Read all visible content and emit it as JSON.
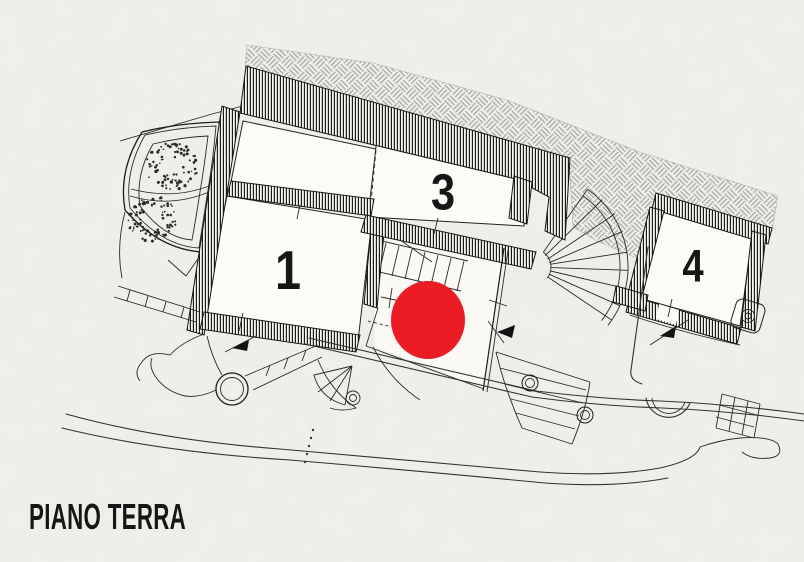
{
  "title": "PIANO TERRA",
  "rooms": [
    {
      "id": "room-1",
      "label": "1"
    },
    {
      "id": "room-3",
      "label": "3"
    },
    {
      "id": "room-4",
      "label": "4"
    }
  ],
  "marker": {
    "name": "highlighted-location",
    "color": "#ec1c24"
  },
  "colors": {
    "paper": "#f1f0ea",
    "ink": "#1c1c1c",
    "hatch_gray": "#a6a6a2",
    "room_fill": "#fcfcf7"
  }
}
